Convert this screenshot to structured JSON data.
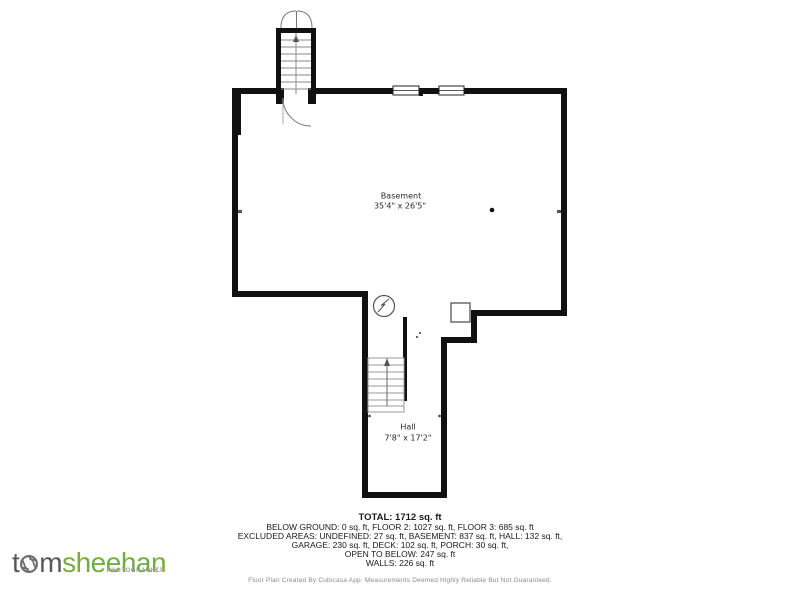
{
  "floorplan": {
    "basement": {
      "name": "Basement",
      "dims": "35'4\" x 26'5\""
    },
    "hall": {
      "name": "Hall",
      "dims": "7'8\" x 17'2\""
    },
    "wall_color": "#111111",
    "symbol_color": "#555555",
    "icons": {
      "stairs_up": "stairs-up-arrow-icon",
      "double_door": "double-door-icon",
      "swing_door": "door-swing-icon",
      "windows": "window-icon",
      "utility": "utility-circle-icon",
      "chimney": "chimney-block-icon"
    }
  },
  "summary": {
    "total": "TOTAL: 1712 sq. ft",
    "lines": [
      "BELOW GROUND: 0 sq. ft, FLOOR 2: 1027 sq. ft, FLOOR 3: 685 sq. ft",
      "EXCLUDED AREAS: UNDEFINED: 27 sq. ft, BASEMENT: 837 sq. ft, HALL: 132 sq. ft,",
      "GARAGE: 230 sq. ft, DECK: 102 sq. ft, PORCH: 30 sq. ft,",
      "OPEN TO BELOW: 247 sq. ft",
      "WALLS: 226 sq. ft"
    ],
    "disclaimer": "Floor Plan Created By Cubicasa App. Measurements Deemed Highly Reliable But Not Guaranteed."
  },
  "logo": {
    "part1": "t",
    "part2": "m",
    "part3": "sheehan",
    "tagline": "PHOTOGRAPHER",
    "gray": "#57585c",
    "green": "#73ad3f"
  }
}
